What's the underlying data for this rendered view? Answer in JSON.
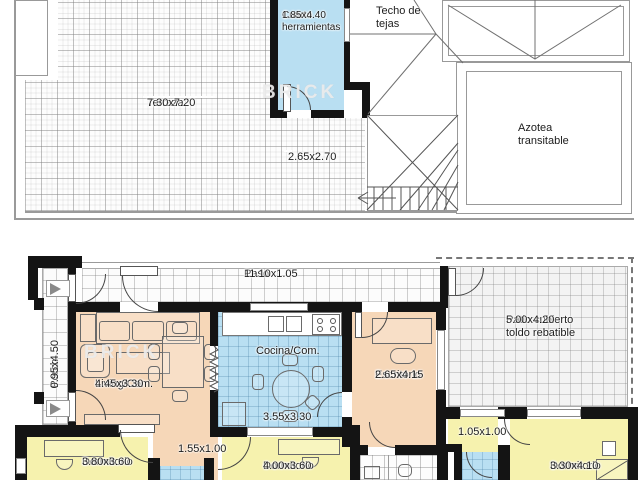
{
  "colors": {
    "wall": "#141414",
    "room_blue": "#b9dff2",
    "room_peach": "#f6d7b8",
    "room_yellow": "#f6f2ae"
  },
  "watermark": {
    "text": "BRICK"
  },
  "rooms": {
    "terraza": {
      "name": "Terraza",
      "dims": "7.30x7.20"
    },
    "cuarto_herramientas": {
      "name": "Cuarto herramientas",
      "dims": "1.85x4.40"
    },
    "techo": {
      "name": "Techo de tejas"
    },
    "azotea": {
      "name": "Azotea transitable"
    },
    "escalera": {
      "dims": "2.65x2.70"
    },
    "paso": {
      "name": "Paso",
      "dims": "11.10x1.05"
    },
    "porch": {
      "name": "Porch",
      "dims": "0.95x4.50"
    },
    "living": {
      "name": "Living/Com.",
      "dims": "4.45x3.30"
    },
    "cocina": {
      "name": "Cocina/Com.",
      "dims": "3.55x3.30"
    },
    "escritorio": {
      "name": "Escritorio",
      "dims": "2.65x4.15"
    },
    "patio": {
      "name": "Patio cubierto toldo rebatible",
      "dims": "5.00x4.20"
    },
    "dormitorio_izq": {
      "name": "Dormitorio",
      "dims": "3.80x3.60"
    },
    "dormitorio_centro": {
      "name": "Dormitorio",
      "dims": "4.00x3.60"
    },
    "dormitorio_der": {
      "name": "Dormitorio",
      "dims": "3.30x4.10"
    },
    "pasillo_dormitorios": {
      "dims": "1.55x1.00"
    },
    "pasillo_suite": {
      "dims": "1.05x1.00"
    }
  }
}
